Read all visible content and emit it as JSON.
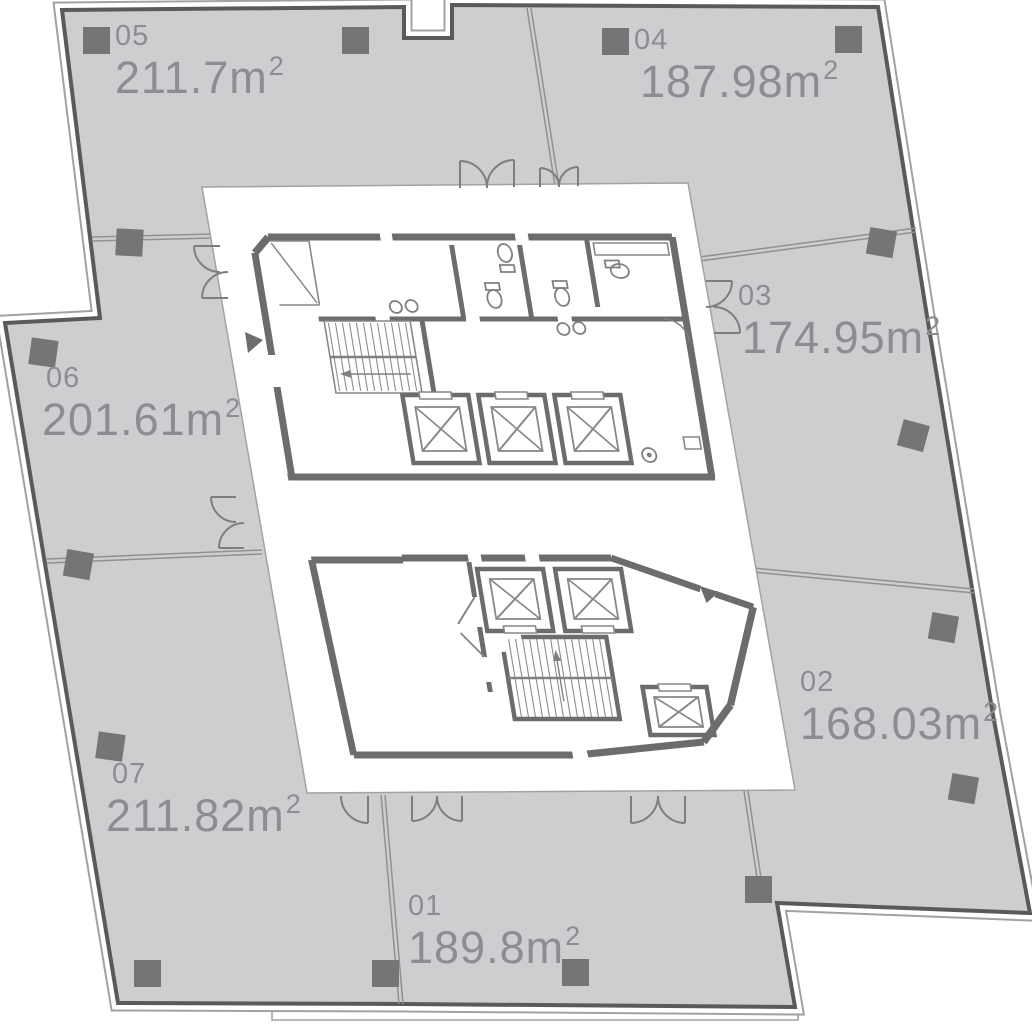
{
  "plan": {
    "kind": "office-floor-plan",
    "area_unit_prefix": "m",
    "area_unit_sup": "2"
  },
  "units": [
    {
      "id": "05",
      "area": "211.7",
      "unit": "m",
      "sup": "2"
    },
    {
      "id": "04",
      "area": "187.98",
      "unit": "m",
      "sup": "2"
    },
    {
      "id": "03",
      "area": "174.95",
      "unit": "m",
      "sup": "2"
    },
    {
      "id": "06",
      "area": "201.61",
      "unit": "m",
      "sup": "2"
    },
    {
      "id": "02",
      "area": "168.03",
      "unit": "m",
      "sup": "2"
    },
    {
      "id": "07",
      "area": "211.82",
      "unit": "m",
      "sup": "2"
    },
    {
      "id": "01",
      "area": "189.8",
      "unit": "m",
      "sup": "2"
    }
  ],
  "colors": {
    "unit_fill": "#cdced0",
    "outer_wall": "#595a5c",
    "outer_outline": "#9fa1a3",
    "core_wall": "#6b6c6e",
    "core_bg": "#ffffff",
    "fixture": "#7e8082",
    "partition": "#8f9193",
    "column": "#747577",
    "label_text": "#8b8d90"
  }
}
